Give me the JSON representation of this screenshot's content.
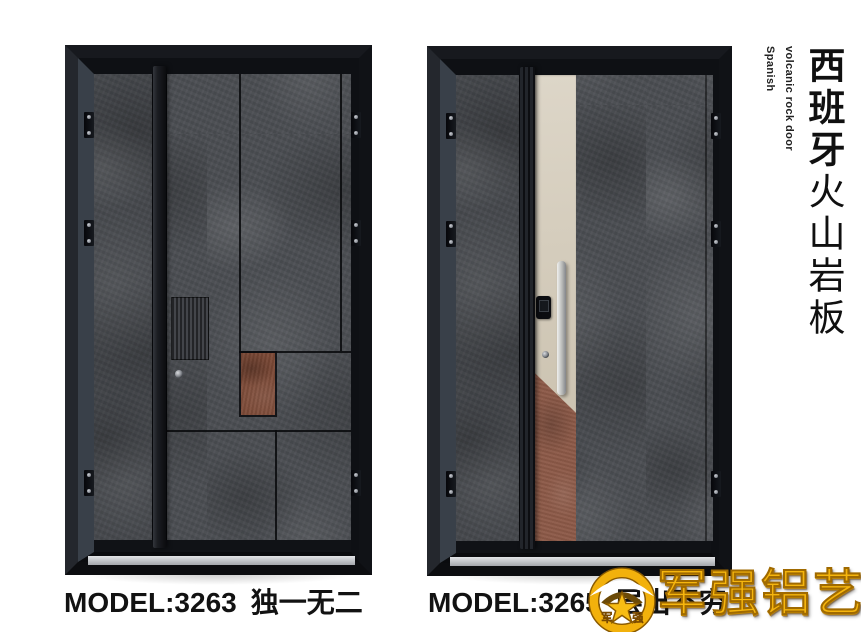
{
  "page": {
    "background": "#ffffff"
  },
  "side_title": {
    "en_line1": "Spanish",
    "en_line2": "volcanic rock door",
    "zh_bold": "西班牙",
    "zh_regular": "火山岩板"
  },
  "products": [
    {
      "model": "MODEL:3263",
      "name": "独一无二"
    },
    {
      "model": "MODEL:3265",
      "name": "层出不穷"
    }
  ],
  "brand": {
    "wordmark": "军强铝艺",
    "emblem_left_char": "军",
    "emblem_right_char": "强"
  },
  "colors": {
    "rock_gray": "#4b4e53",
    "rust_accent_left": "#7d4a37",
    "rust_accent_right": "#8d5a48",
    "champagne_strip": "#d5ccbc",
    "frame_black": "#121419",
    "logo_gold": "#f2b10c",
    "text_black": "#121212"
  }
}
